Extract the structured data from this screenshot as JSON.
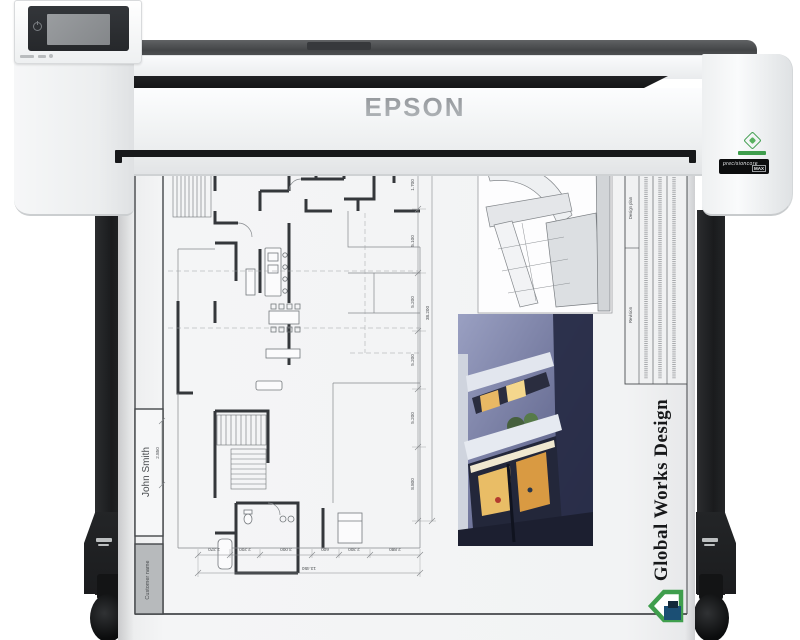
{
  "printer": {
    "brand": "EPSON",
    "badge": {
      "line1": "precisioncore",
      "line2": "MAX"
    }
  },
  "print": {
    "customer_label": "Customer name",
    "customer_name": "John Smith",
    "company": "Global Works Design",
    "table": {
      "header_top": "Design plan",
      "header_bottom": "Revision"
    },
    "dims": {
      "vertical": [
        "1.700",
        "5.100",
        "5.200",
        "5.200",
        "5.200",
        "8.800"
      ],
      "vertical_total": "38.200",
      "bottom": [
        "2.370",
        "2.200",
        "3.000",
        "600",
        "2.300",
        "2.880"
      ],
      "bottom_total": "13.450",
      "left": "2.850"
    }
  },
  "colors": {
    "logo_green": "#3f9e4d",
    "logo_blue": "#1b4f74",
    "window_warm": "#e9bd66",
    "leg_black": "#1a1b1d"
  }
}
